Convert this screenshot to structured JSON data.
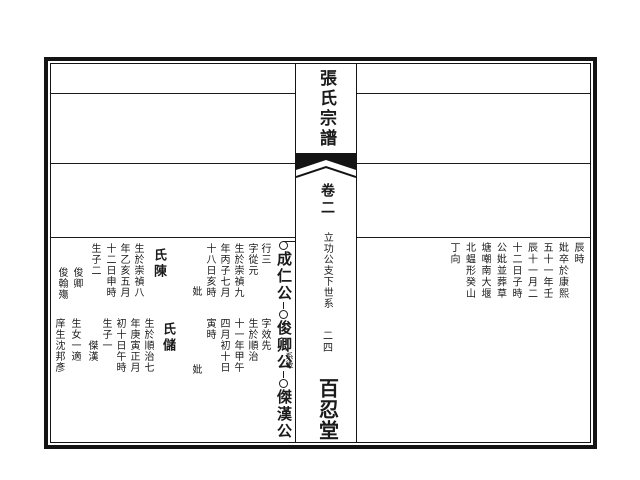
{
  "spine": {
    "title": "張氏宗譜",
    "volume": "卷二",
    "section": "立功公支下世系",
    "page_number": "二四",
    "hall": "百忍堂"
  },
  "right_page": {
    "columns": [
      "辰時",
      "妣卒於康熙",
      "五十一年壬",
      "辰十一月二",
      "十二日子時",
      "公妣並葬草",
      "塘嘲南大堰",
      "北蝹形癸山",
      "丁向"
    ]
  },
  "left_page": {
    "lineage": {
      "nodes": [
        "成仁公",
        "俊卿公",
        "傑漢公"
      ],
      "annotation": "系後"
    },
    "record1": {
      "cols": [
        "行三",
        "字從元",
        "生於崇禎九",
        "年丙子七月",
        "十八日亥時",
        "妣",
        "氏陳",
        "生於崇禎八",
        "年乙亥五月",
        "十二日申時",
        "生子二",
        "俊卿",
        "俊翰殤"
      ]
    },
    "record2": {
      "cols": [
        "字效先",
        "生於順治",
        "十一年甲午",
        "四月初十日",
        "寅時",
        "妣",
        "氏儲",
        "生於順治七",
        "年庚寅正月",
        "初十日午時",
        "生子一",
        "傑漢",
        "生女一適",
        "庠生沈邦彥"
      ]
    }
  }
}
